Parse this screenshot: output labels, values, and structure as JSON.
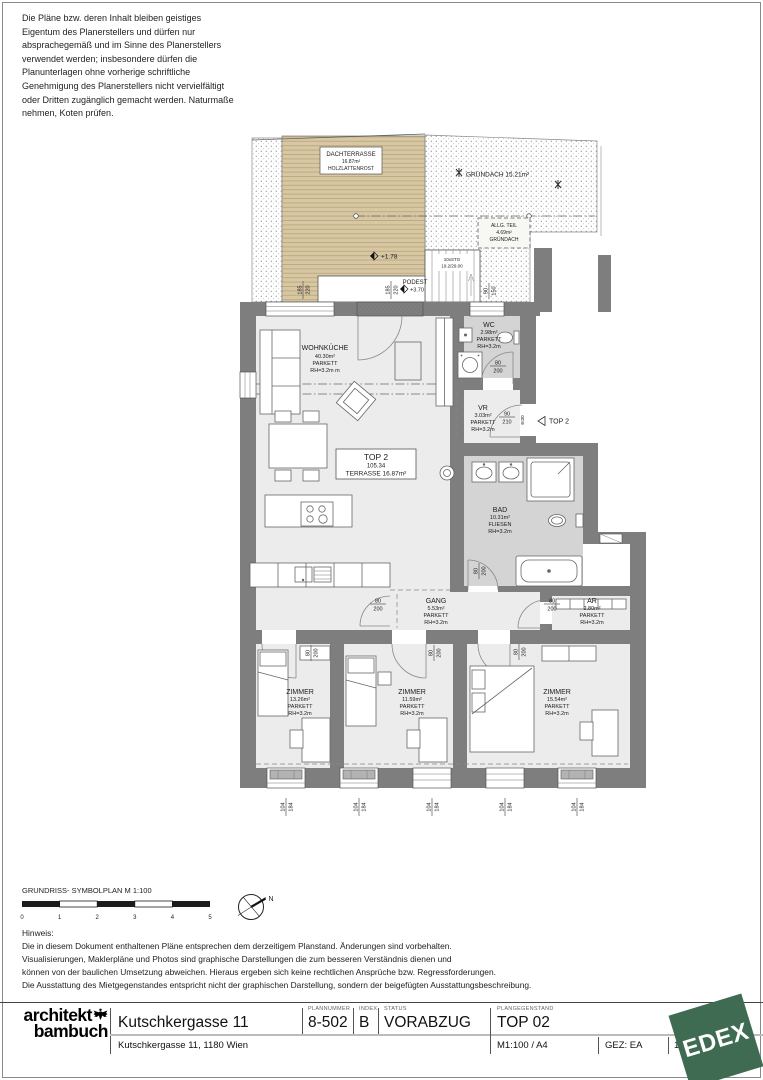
{
  "copyright_lines": [
    "Die Pläne bzw. deren Inhalt bleiben geistiges",
    "Eigentum des Planerstellers und dürfen nur",
    "absprachegemäß und im Sinne des Planerstellers",
    "verwendet werden; insbesondere dürfen die",
    "Planunterlagen ohne vorherige schriftliche",
    "Genehmigung des Planerstellers nicht vervielfältigt",
    "oder Dritten zugänglich gemacht werden. Naturmaße",
    "nehmen, Koten prüfen."
  ],
  "plan": {
    "dachterrasse": {
      "name": "DACHTERRASSE",
      "area": "16.87m²",
      "note": "HOLZLATTENROST"
    },
    "gruendach_label": "GRÜNDACH 15.21m²",
    "allg_teil": {
      "l1": "ALLG. TEIL",
      "l2": "4.69m²",
      "l3": "GRÜNDACH"
    },
    "level_terrace": "+1.78",
    "stairs": {
      "l1": "10xSTG",
      "l2": "19.2/29.00"
    },
    "podest": {
      "l1": "PODEST",
      "l2": "+3.70"
    },
    "unit_box": {
      "l1": "TOP 2",
      "l2": "105.34",
      "l3": "TERRASSE 16.87m²"
    },
    "entry": {
      "label": "TOP 2",
      "fire_rating": "EI30"
    },
    "rooms": {
      "wohnkueche": {
        "name": "WOHNKÜCHE",
        "area": "40.30m²",
        "floor": "PARKETT",
        "height": "RH=3.2m m"
      },
      "wc": {
        "name": "WC",
        "area": "2.98m²",
        "floor": "PARKETT",
        "height": "RH=3.2m"
      },
      "vr": {
        "name": "VR",
        "area": "3.03m²",
        "floor": "PARKETT",
        "height": "RH=3.2m"
      },
      "bad": {
        "name": "BAD",
        "area": "10.31m²",
        "floor": "FLIESEN",
        "height": "RH=3.2m"
      },
      "gang": {
        "name": "GANG",
        "area": "5.53m²",
        "floor": "PARKETT",
        "height": "RH=3.2m"
      },
      "ar": {
        "name": "AR",
        "area": "2.80m²",
        "floor": "PARKETT",
        "height": "RH=3.2m"
      },
      "zimmer1": {
        "name": "ZIMMER",
        "area": "13.26m²",
        "floor": "PARKETT",
        "height": "RH=3.2m"
      },
      "zimmer2": {
        "name": "ZIMMER",
        "area": "11.59m²",
        "floor": "PARKETT",
        "height": "RH=3.2m"
      },
      "zimmer3": {
        "name": "ZIMMER",
        "area": "15.54m²",
        "floor": "PARKETT",
        "height": "RH=3.2m"
      }
    },
    "dims": {
      "door": {
        "w": "80",
        "h": "200"
      },
      "entry_door": {
        "w": "90",
        "h": "210"
      },
      "window": {
        "w": "104",
        "h": "184"
      },
      "terrace_door": {
        "w": "185",
        "h": "220"
      },
      "stair_window": {
        "w": "90",
        "h": "150"
      }
    }
  },
  "scalebar": {
    "title": "GRUNDRISS- SYMBOLPLAN M 1:100",
    "ticks": [
      "0",
      "1",
      "2",
      "3",
      "4",
      "5"
    ],
    "north": "N"
  },
  "hinweis": {
    "title": "Hinweis:",
    "lines": [
      "Die in diesem Dokument enthaltenen Pläne entsprechen dem derzeitigem Planstand. Änderungen sind vorbehalten.",
      "Visualisierungen, Maklerpläne und Photos sind graphische Darstellungen die zum besseren Verständnis dienen und",
      "können von der baulichen Umsetzung abweichen. Hieraus ergeben sich keine rechtlichen Ansprüche bzw. Regressforderungen.",
      "Die Ausstattung des Mietgegenstandes entspricht nicht der graphischen Darstellung, sondern der beigefügten Ausstattungsbeschreibung."
    ]
  },
  "titleblock": {
    "logo1": "architekt",
    "logo2": "bambuch",
    "project": "Kutschkergasse 11",
    "address": "Kutschkergasse 11, 1180 Wien",
    "plannummer_label": "PLANNUMMER",
    "plannummer": "8-502",
    "index_label": "INDEX",
    "index": "B",
    "status_label": "STATUS",
    "status": "VORABZUG",
    "gegenstand_label": "PLANGEGENSTAND",
    "gegenstand": "TOP 02",
    "format": "M1:100 / A4",
    "gez": "GEZ: EA",
    "page": "1/",
    "edex": "EDEX"
  }
}
